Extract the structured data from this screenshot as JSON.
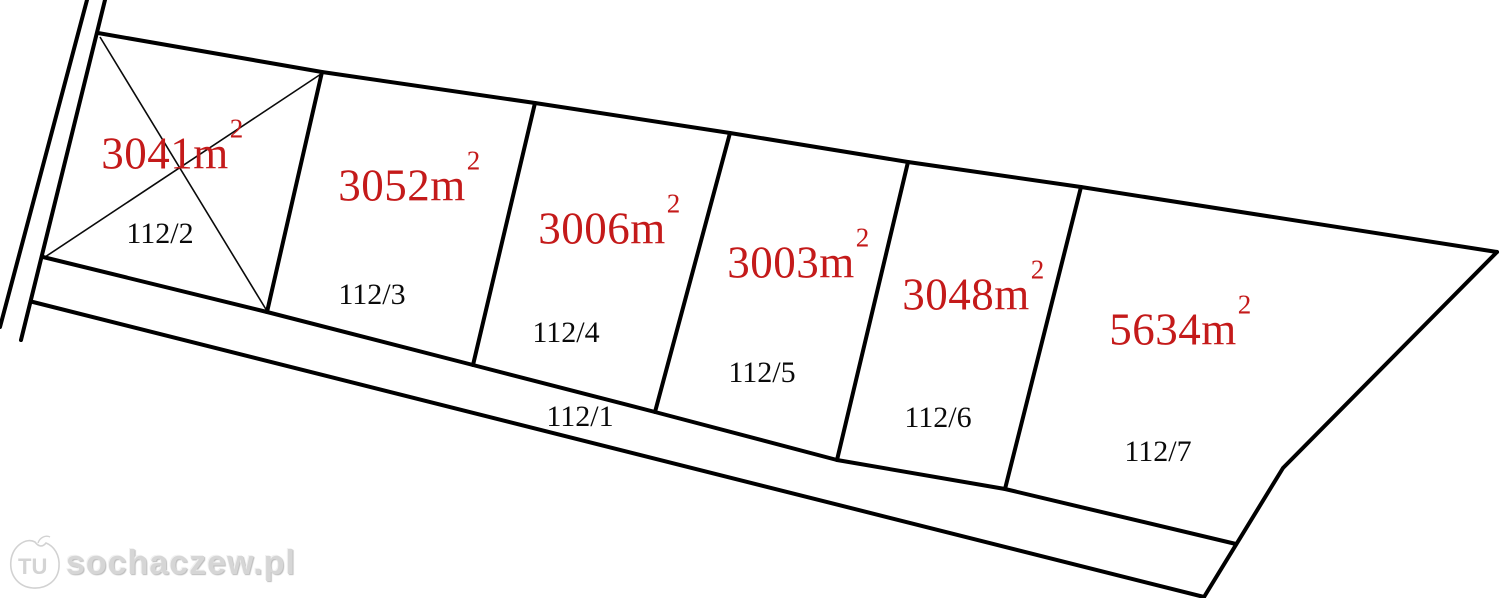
{
  "map": {
    "kind": "land-parcel-subdivision-plan"
  },
  "colors": {
    "area_label": "#c41a1a",
    "boundary_line": "#000000",
    "watermark": "#d6d6d6"
  },
  "plots": [
    {
      "number": "112/1",
      "area": null,
      "area_sup": null
    },
    {
      "number": "112/2",
      "area": "3041m",
      "area_sup": "2"
    },
    {
      "number": "112/3",
      "area": "3052m",
      "area_sup": "2"
    },
    {
      "number": "112/4",
      "area": "3006m",
      "area_sup": "2"
    },
    {
      "number": "112/5",
      "area": "3003m",
      "area_sup": "2"
    },
    {
      "number": "112/6",
      "area": "3048m",
      "area_sup": "2"
    },
    {
      "number": "112/7",
      "area": "5634m",
      "area_sup": "2"
    }
  ],
  "watermark": {
    "logo_text": "TU",
    "site_text": "sochaczew.pl"
  }
}
